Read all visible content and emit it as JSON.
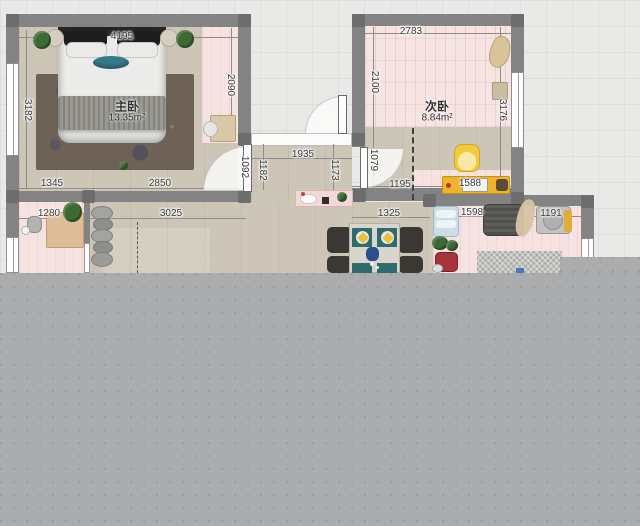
{
  "app": {
    "view": "floorplan-2d-canvas"
  },
  "rooms": {
    "master_bedroom": {
      "label": "主卧",
      "area": "13.35m²"
    },
    "secondary_bedroom": {
      "label": "次卧",
      "area": "8.84m²"
    }
  },
  "dimensions_mm": {
    "master_top": "4195",
    "master_left": "3182",
    "master_right_inner": "2090",
    "master_bottom_left": "1345",
    "master_bottom_right": "2850",
    "master_door": "1092",
    "hall_left": "1182",
    "hall_top": "1935",
    "hall_right": "1173",
    "secondary_top": "2783",
    "secondary_left": "2100",
    "secondary_right": "3176",
    "secondary_lower_left": "1079",
    "secondary_bottom_left": "1195",
    "secondary_bottom_right": "1588",
    "balcony_width": "1280",
    "living_width": "3025",
    "dining_width": "1325",
    "lower_room_left": "1598",
    "lower_room_right": "1191"
  },
  "palette": {
    "wall": "#838383",
    "wall_joint": "#6d6d6d",
    "wood_floor": "#cdc5b6",
    "pink_floor": "#f5e2e1",
    "outside_background": "#e9e9e7",
    "cutoff_overlay": "#aaacae",
    "desk_yellow": "#efb42c",
    "chair_yellow": "#f2ca3d",
    "placemat_teal": "#2f6a6d",
    "pillow_teal": "#36798a",
    "rug_brown": "#6e6257",
    "accent_red": "#a8323a"
  }
}
